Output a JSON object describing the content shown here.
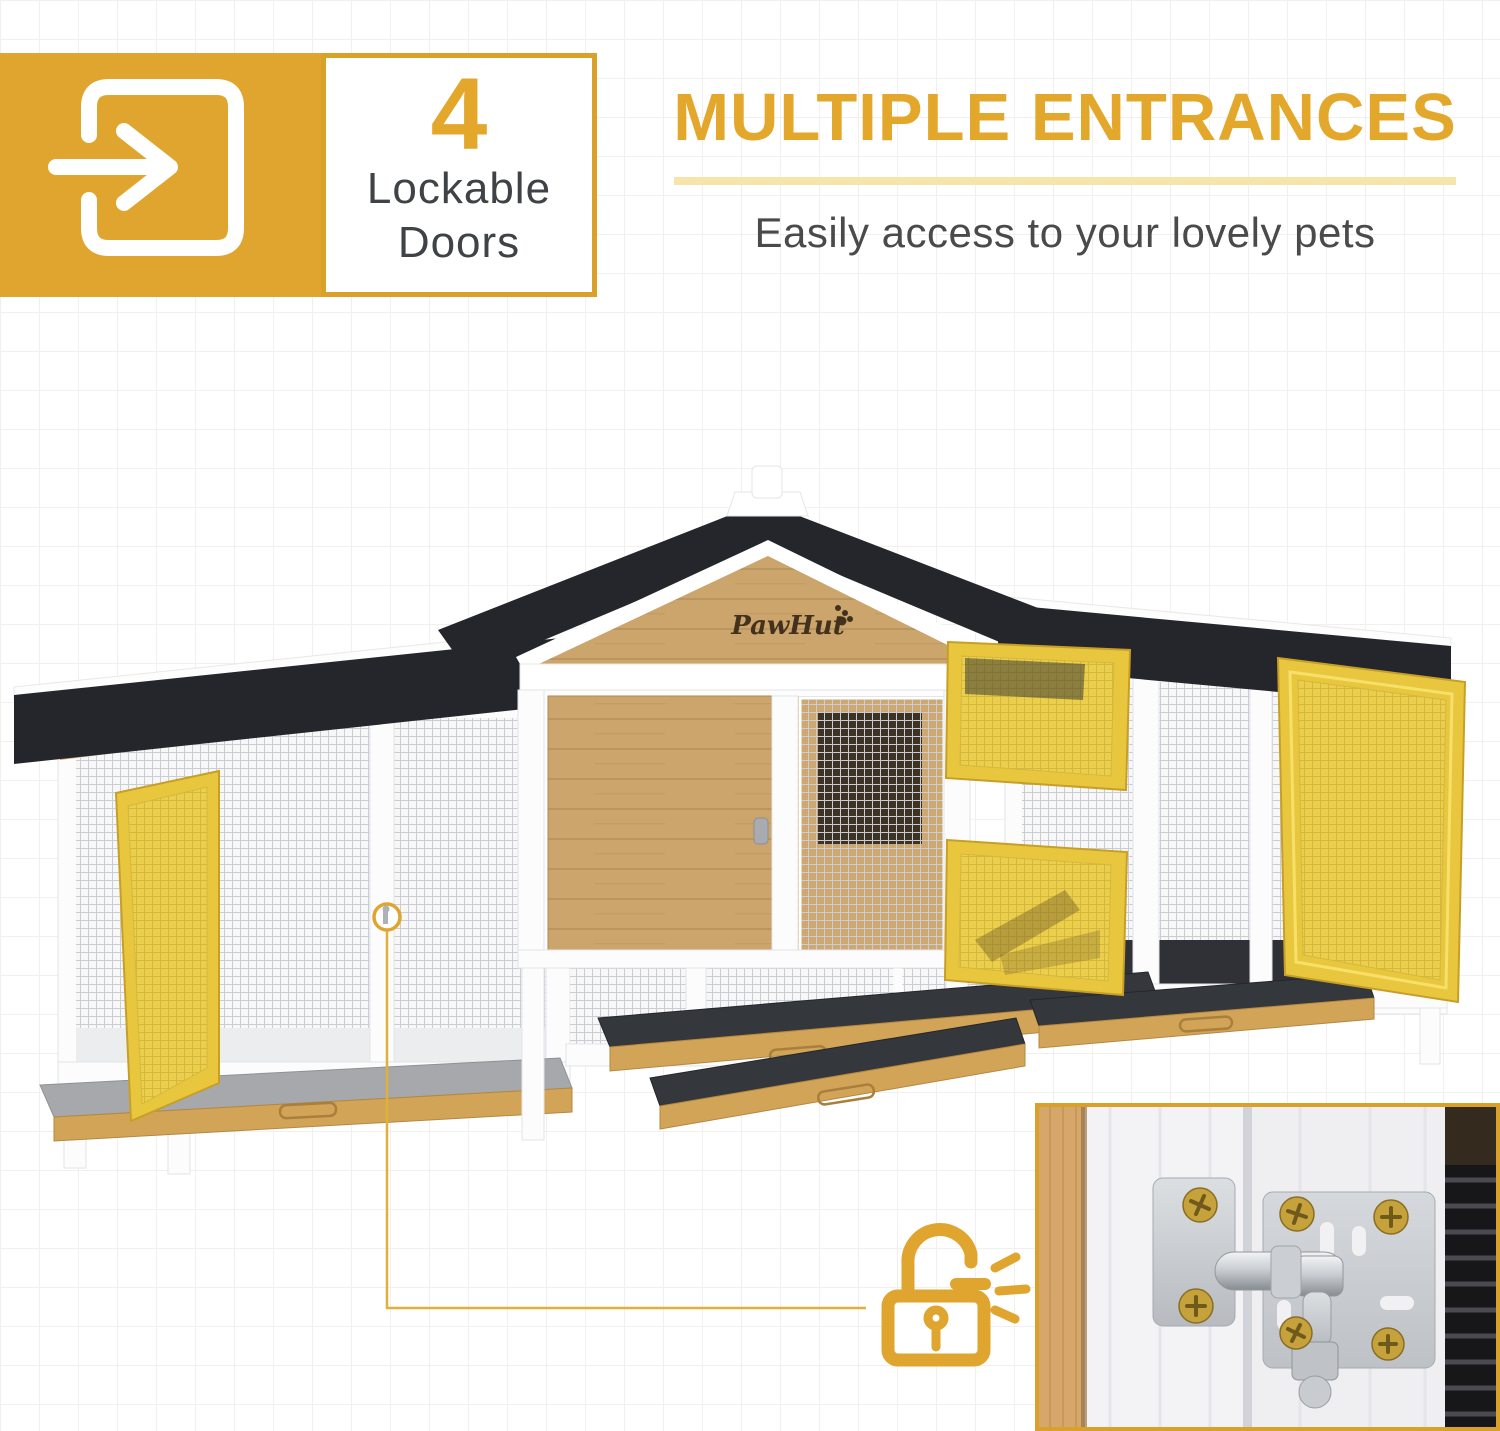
{
  "badge": {
    "icon": "door-enter-icon",
    "count": "4",
    "label": [
      "Lockable",
      "Doors"
    ]
  },
  "headline": {
    "title": "MULTIPLE ENTRANCES",
    "subtitle": "Easily access to your lovely pets"
  },
  "hutch": {
    "brand": "PawHut"
  },
  "callout": {
    "line_icon": "latch-circle-icon",
    "lock_icon": "padlock-unlocked-icon"
  },
  "inset": {
    "subject": "door-slide-bolt-latch-closeup"
  },
  "colors": {
    "accent": "#E3A82B",
    "accent_deep": "#D9A02A",
    "divider_pale": "#F7E4A9",
    "door_yellow": "#E9CB4B",
    "roof_black": "#25262B",
    "wood": "#CCA56C",
    "tray_wood": "#D2A458",
    "felt_dark": "#34373C",
    "felt_gray": "#A6A8AC",
    "text_dark": "#3F4347",
    "text_gray": "#4A4A4A",
    "grid_line": "#F2EFEE",
    "metal": "#C9CCD0",
    "screw_gold": "#C6A23C",
    "white_frame": "#FCFCFD"
  }
}
